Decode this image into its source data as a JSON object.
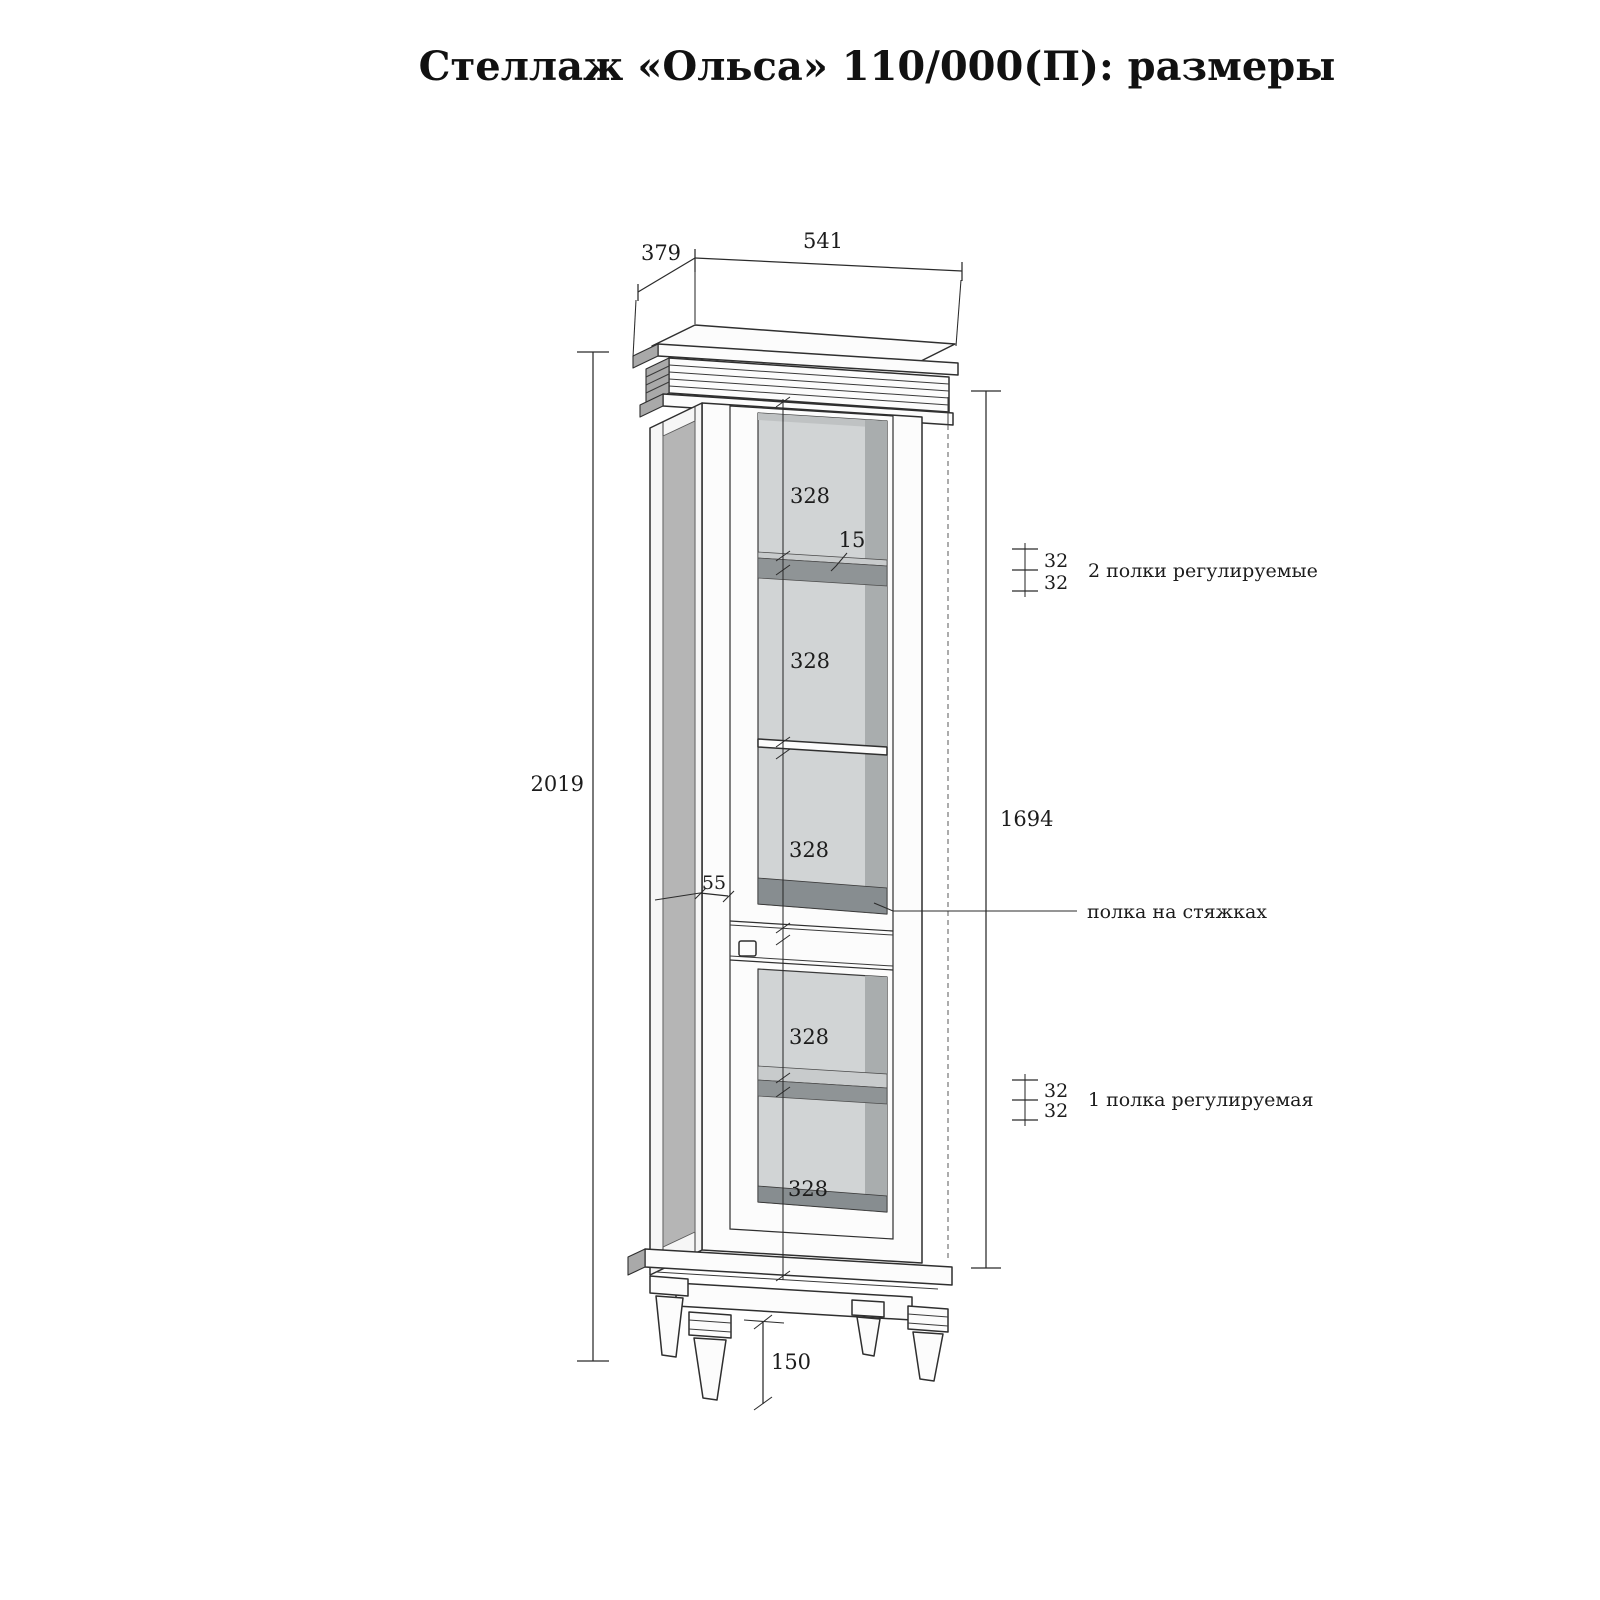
{
  "title": "Стеллаж «Ольса»  110/000(П): размеры",
  "dimensions": {
    "top_width": "541",
    "top_depth": "379",
    "overall_height": "2019",
    "inner_height": "1694",
    "leg_height": "150",
    "stile_width": "55",
    "shelf_thickness": "15",
    "sections": [
      "328",
      "328",
      "328",
      "328",
      "328"
    ],
    "pitch_top": [
      "32",
      "32"
    ],
    "pitch_bottom": [
      "32",
      "32"
    ]
  },
  "annotations": {
    "adjustable_shelves_top": "2 полки регулируемые",
    "fixed_shelf": "полка на стяжках",
    "adjustable_shelf_bottom": "1 полка регулируемая"
  }
}
